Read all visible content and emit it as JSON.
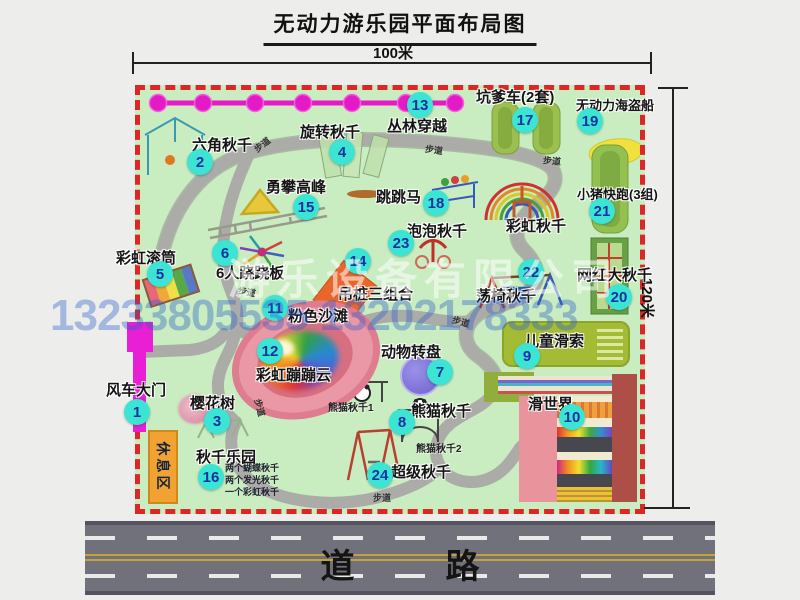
{
  "title": "无动力游乐园平面布局图",
  "dimensions": {
    "width_label": "100米",
    "height_label": "120米"
  },
  "road": {
    "label": "道 路"
  },
  "watermark": {
    "company": "游乐设备有限公司",
    "phones": "13233805535 13202178333"
  },
  "rest_area_label": "休息区",
  "path_label": "步道",
  "attractions": [
    {
      "id": "1",
      "name": "风车大门"
    },
    {
      "id": "2",
      "name": "六角秋千"
    },
    {
      "id": "3",
      "name": "樱花树"
    },
    {
      "id": "4",
      "name": "旋转秋千"
    },
    {
      "id": "5",
      "name": "彩虹滚筒"
    },
    {
      "id": "6",
      "name": "6人跷跷板"
    },
    {
      "id": "7",
      "name": "动物转盘"
    },
    {
      "id": "8",
      "name": "熊猫秋千"
    },
    {
      "id": "9",
      "name": "儿童滑索"
    },
    {
      "id": "10",
      "name": "滑世界"
    },
    {
      "id": "11",
      "name": "粉色沙滩"
    },
    {
      "id": "12",
      "name": "彩虹蹦蹦云"
    },
    {
      "id": "13",
      "name": "丛林穿越"
    },
    {
      "id": "14",
      "name": "吊桩三组合"
    },
    {
      "id": "15",
      "name": "勇攀高峰"
    },
    {
      "id": "16",
      "name": "秋千乐园"
    },
    {
      "id": "17",
      "name": "坑爹车(2套)"
    },
    {
      "id": "18",
      "name": "跳跳马"
    },
    {
      "id": "19",
      "name": "无动力海盗船"
    },
    {
      "id": "20",
      "name": "网红大秋千"
    },
    {
      "id": "21",
      "name": "小猪快跑(3组)"
    },
    {
      "id": "22",
      "name": "荡椅秋千"
    },
    {
      "id": "23",
      "name": "泡泡秋千"
    },
    {
      "id": "24",
      "name": "超级秋千"
    }
  ],
  "extra_labels": {
    "rainbow_swing": "彩虹秋千",
    "panda_swing_1": "熊猫秋千1",
    "panda_swing_2": "熊猫秋千2"
  },
  "swing_park_notes": [
    "两个蝴蝶秋千",
    "两个发光秋千",
    "一个彩虹秋千"
  ],
  "colors": {
    "map_green": "#c9ecc0",
    "border_red": "#dd2626",
    "badge_cyan": "#3ce4d4",
    "badge_text": "#1633a0",
    "jungle_line_magenta": "#e818c8",
    "gate_magenta": "#e81fd4",
    "rest_orange": "#f2a232",
    "road_gray": "#71717c"
  }
}
